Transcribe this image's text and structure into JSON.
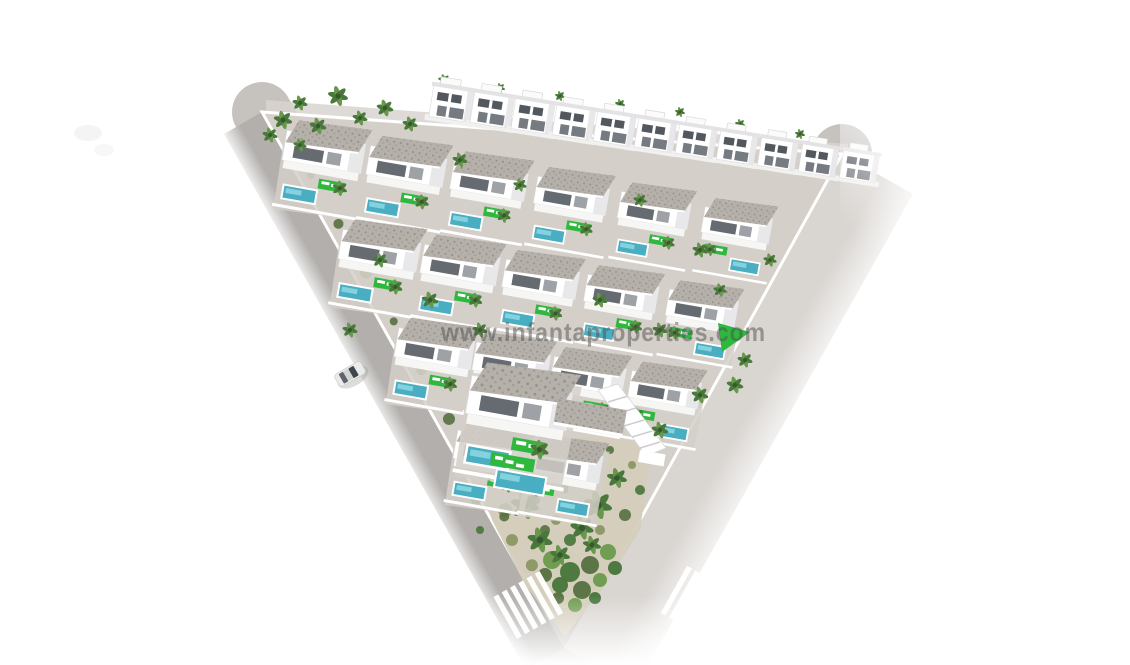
{
  "watermark": {
    "text": "www.infantaproperties.com"
  },
  "scene": {
    "name": "residential-development-aerial-render",
    "counts": {
      "back_row_villas": 11,
      "villa_rows": [
        6,
        5,
        4,
        2
      ],
      "crosswalks": 2,
      "cars": 1
    }
  },
  "colors": {
    "background": "#ffffff",
    "road_left": "#b2afac",
    "road_right": "#d9d5d1",
    "road_corner": "#c6c2be",
    "paving": "#d4cfc8",
    "sand": "#d5cdbc",
    "wall_shade": "#e8e8eb",
    "roof": "#b5b1aa",
    "roof_dark": "#8e8a83",
    "pool": "#49aec2",
    "pool_light": "#93dbe3",
    "lawn": "#2fb83e",
    "palm_green": "#6b9a4d",
    "palm_dark": "#47753a",
    "shrub": "#86955e",
    "shrub_dark": "#55703f",
    "window_dark": "#3f464d",
    "car_body": "#ebecea",
    "crosswalk": "#ffffff",
    "watermark_color": "rgba(80,80,80,0.5)"
  }
}
